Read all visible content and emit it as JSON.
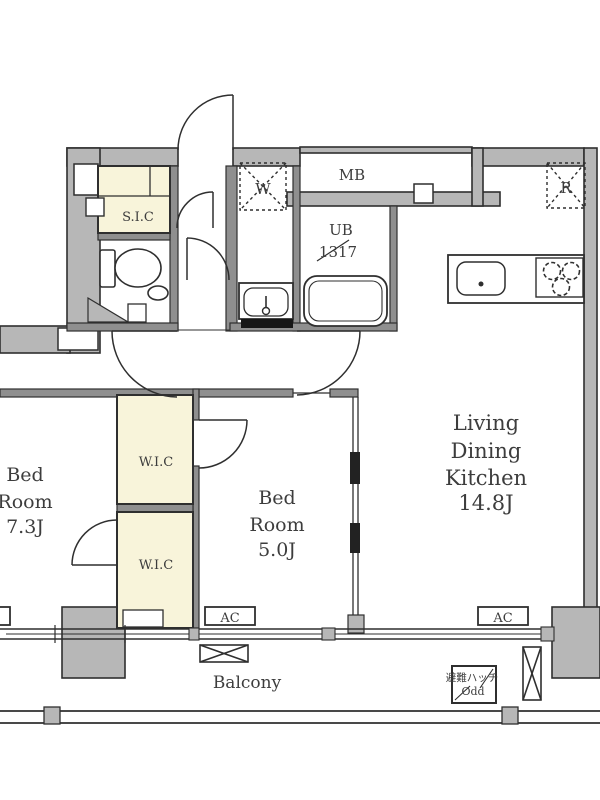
{
  "title": "apartment-floor-plan",
  "colors": {
    "wall": "#b7b7b7",
    "outline": "#2f2f2f",
    "closet": "#f8f4da",
    "text": "#3d3d3d"
  },
  "rooms": {
    "ldk": {
      "line1": "Living",
      "line2": "Dining",
      "line3": "Kitchen",
      "line4": "14.8J"
    },
    "bed5": {
      "line1": "Bed",
      "line2": "Room",
      "line3": "5.0J"
    },
    "bed7": {
      "line1": "Bed",
      "line2": "Room",
      "line3": "7.3J"
    },
    "sic": {
      "label": "S.I.C"
    },
    "wic": {
      "label": "W.I.C"
    },
    "ub": {
      "label": "UB",
      "size": "1317"
    },
    "mb": {
      "label": "MB"
    },
    "washer": {
      "label": "W"
    },
    "fridge": {
      "label": "R"
    },
    "balcony": {
      "label": "Balcony"
    },
    "ac": {
      "label": "AC"
    },
    "hatch": {
      "jp": "避難ハッチ",
      "en": "Odd"
    }
  }
}
